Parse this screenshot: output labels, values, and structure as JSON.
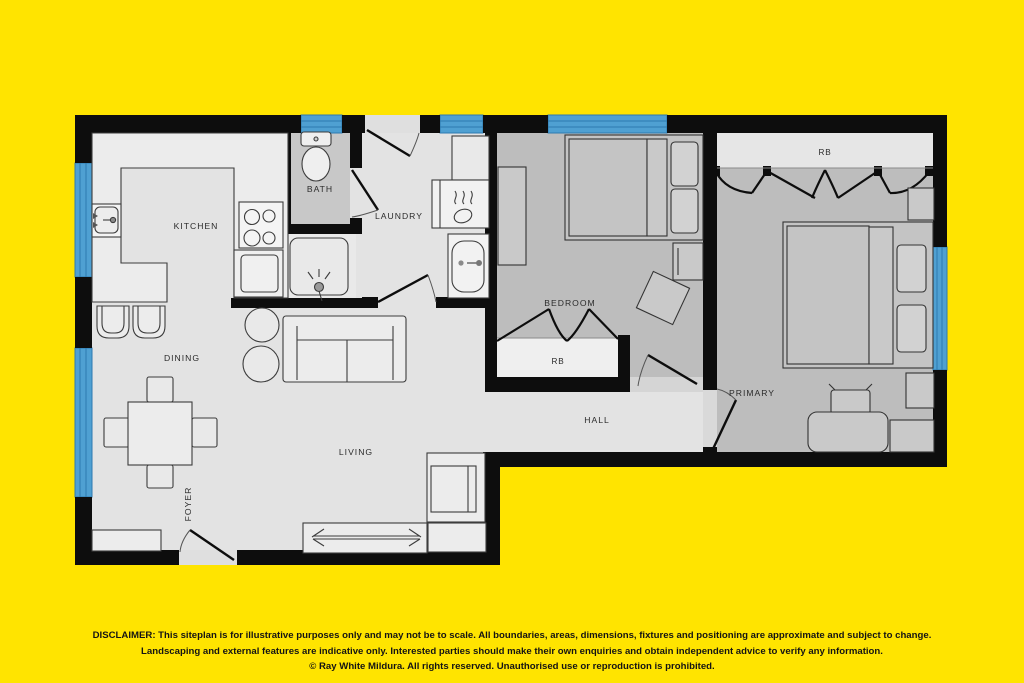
{
  "plan": {
    "labels": {
      "kitchen": "KITCHEN",
      "bath": "BATH",
      "laundry": "LAUNDRY",
      "bedroom": "BEDROOM",
      "bedroom_robe": "RB",
      "primary_robe": "RB",
      "primary": "PRIMARY",
      "hall": "HALL",
      "dining": "DINING",
      "living": "LIVING",
      "foyer": "FOYER"
    },
    "colors": {
      "background": "#FFE400",
      "wall": "#0D0D0D",
      "window_blue": "#4FA0D2",
      "window_line": "#2D7AB0",
      "floor_light": "#E3E3E3",
      "floor_bedroom": "#BDBDBD",
      "floor_bath": "#C8C8C8",
      "robe_fill": "#EFEFEF"
    }
  },
  "disclaimer": {
    "line1": "DISCLAIMER: This siteplan is for illustrative purposes only and may not be to scale. All boundaries, areas, dimensions, fixtures and positioning are approximate and subject to change.",
    "line2": "Landscaping and external features are indicative only. Interested parties should make their own enquiries and obtain independent advice to verify any information.",
    "line3": "© Ray White Mildura. All rights reserved. Unauthorised use or reproduction is prohibited."
  }
}
